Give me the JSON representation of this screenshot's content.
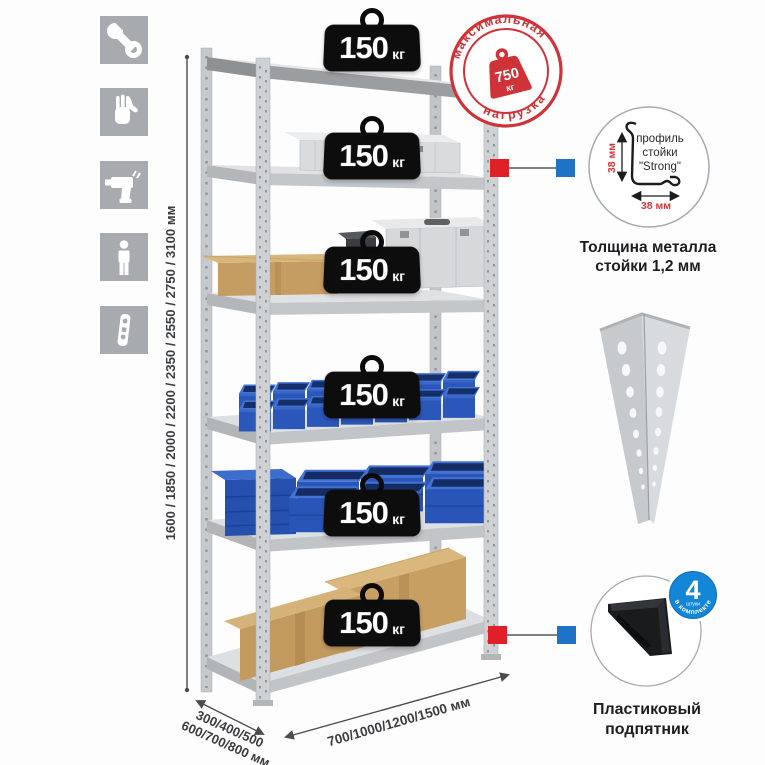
{
  "colors": {
    "accent_red": "#cf3338",
    "connector_red": "#e01f26",
    "connector_blue": "#1e73c8",
    "bin_blue": "#2a55b8",
    "metal_gray": "#cfd2d5",
    "badge_blue": "#1486d8",
    "weight_black": "#0d0d0e"
  },
  "assembly_icons": [
    "wrench",
    "gloves",
    "drill",
    "person",
    "upright-profile"
  ],
  "rack": {
    "shelves": 6
  },
  "shelf_badge": {
    "value": "150",
    "unit": "кг"
  },
  "stamp": {
    "top": "максимальная",
    "bottom": "нагрузка",
    "value": "750",
    "unit": "кг"
  },
  "dimensions": {
    "height": "1600 / 1850 / 2000 / 2200 / 2350 / 2550 / 2750 / 3100 мм",
    "depth1": "300/400/500",
    "depth2": "600/700/800 мм",
    "width": "700/1000/1200/1500 мм"
  },
  "profile": {
    "l1": "профиль",
    "l2": "стойки",
    "l3": "\"Strong\"",
    "dim_v": "38 мм",
    "dim_h": "38 мм",
    "cap1": "Толщина металла",
    "cap2": "стойки 1,2 мм"
  },
  "foot": {
    "cap1": "Пластиковый",
    "cap2": "подпятник",
    "badge_value": "4",
    "badge_unit": "штуки",
    "badge_arc": "в комплекте"
  }
}
